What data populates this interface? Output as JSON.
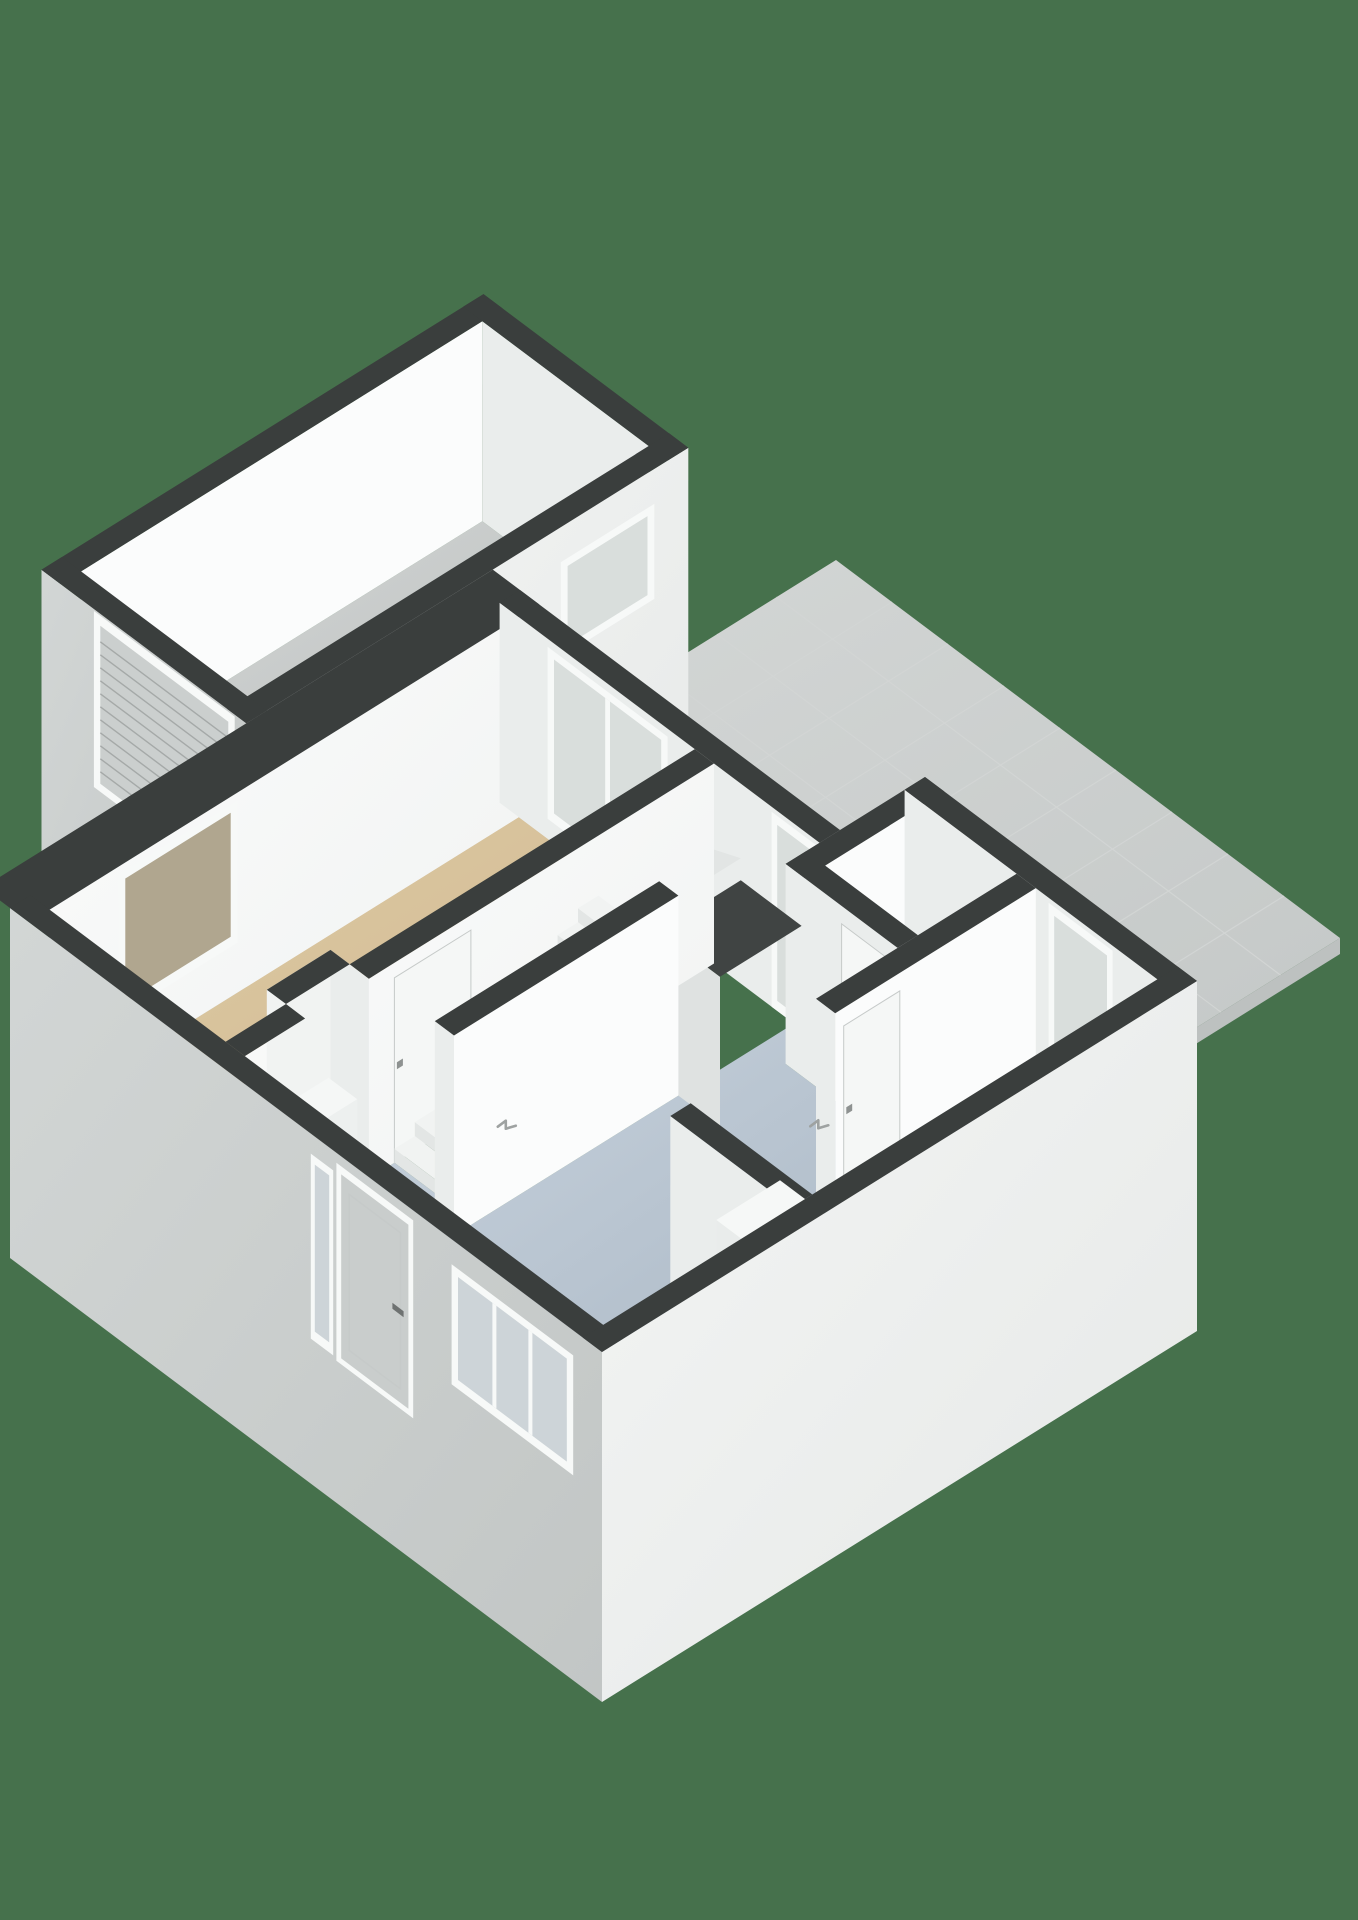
{
  "scene": {
    "type": "3d-floor-plan-render",
    "background_color": "#46714C",
    "projection": "isometric"
  },
  "colors": {
    "wall_top": "#3A3E3D",
    "face_bright": "#FBFCFC",
    "face_bright2": "#EFF1F0",
    "face_light": "#EAEDEC",
    "face_light2": "#DFE2E1",
    "face_soft": "#F1F3F2",
    "ext_sw": "#D2D6D5",
    "ext_sw2": "#C2C6C5",
    "ext_se": "#F3F5F4",
    "ext_se2": "#E6E8E7",
    "frame_white": "#F7F9F8",
    "glass_cool": "#D9DEDC",
    "glass_cool2": "#CDD4D8",
    "glass_brown": "#B0A68F",
    "roller_door": "#CBCFCE",
    "roller_line": "#A5A9A8",
    "door_leaf": "#F5F7F6",
    "door_gap": "#C6CAC9",
    "front_door": "#C9CDCC",
    "handle": "#8E9291",
    "handle_dark": "#6E7271",
    "handle_icon": "#9EA2A1",
    "void_dark": "#404443",
    "riser": "#E3E6E5",
    "counter_top": "#F6F8F7",
    "counter_side": "#E9ECEB",
    "sill_blue": "#C7D3DF",
    "sill_side": "#B5C2CF",
    "tile_line": "#D2D5D4",
    "slab_x": "#BDC1C0",
    "slab_y": "#C7CBCA",
    "shoe_orange": "#A8622C",
    "shoe_dark": "#46423E",
    "niche_floor": "#D9DCDB"
  },
  "rooms": [
    {
      "id": "terrace",
      "name": "terrace",
      "floor": "#D4D7D6",
      "floor2": "#C4C8C7",
      "floor_type": "tiles"
    },
    {
      "id": "garage",
      "name": "garage",
      "floor": "#D3D6D5",
      "floor2": "#B8BCBB",
      "floor_type": "concrete"
    },
    {
      "id": "living_room",
      "name": "living-room",
      "floor": "#E0CCA6",
      "floor2": "#CBB48C",
      "floor_type": "tan"
    },
    {
      "id": "hallway",
      "name": "hallway",
      "floor": "#C5D0DB",
      "floor2": "#ACB9C6",
      "floor_type": "blue"
    },
    {
      "id": "toilet",
      "name": "toilet",
      "floor": "#D3D6D5",
      "floor2": "#CBCFCE",
      "floor_type": "grey"
    },
    {
      "id": "storage_room",
      "name": "storage-room",
      "floor": "#D7A761",
      "floor2": "#BF8D4A",
      "floor_type": "wood"
    },
    {
      "id": "staircase",
      "name": "staircase",
      "floor": "#F1F3F2",
      "floor2": "#E2E5E4",
      "floor_type": "white"
    },
    {
      "id": "niche",
      "name": "coat-niche",
      "floor": "#D9DCDB",
      "floor2": "#D9DCDB",
      "floor_type": "grey"
    }
  ],
  "features": {
    "doors": [
      "front-door",
      "garage-roller-door",
      "terrace-glass-door-living",
      "terrace-glass-door-storage",
      "living-room-door",
      "toilet-door",
      "storage-room-door"
    ],
    "windows": [
      "living-room-side-window",
      "living-room-terrace-window",
      "garage-window",
      "front-window",
      "front-sidelight"
    ],
    "objects": [
      "staircase-with-winders",
      "radiator-in-niche",
      "storage-counter",
      "window-sill-radiator",
      "shoes-pair"
    ]
  }
}
